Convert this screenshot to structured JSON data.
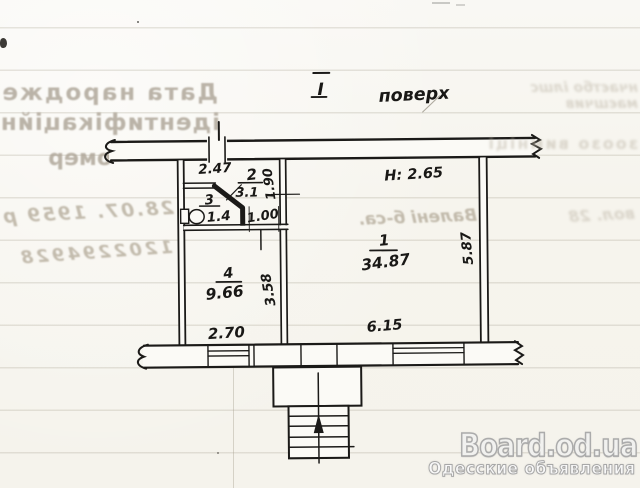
{
  "plan": {
    "title_numeral": "I",
    "title_word": "поверх",
    "height_note": "H: 2.65",
    "rooms": [
      {
        "number": "1",
        "area": "34.87"
      },
      {
        "number": "2",
        "area": "3.1"
      },
      {
        "number": "3",
        "area": "1.4"
      },
      {
        "number": "4",
        "area": "9.66"
      }
    ],
    "dims": {
      "top_width": "2.47",
      "hall_depth": "1.90",
      "hall_width": "1.00",
      "room4_depth": "3.58",
      "room4_width": "2.70",
      "room1_width": "6.15",
      "room1_depth": "5.87"
    }
  },
  "bleedthrough": {
    "form_labels": [
      "Дата народжен",
      "ідентифікаційн",
      "омер"
    ],
    "hand_date": "28.07. 1959 р",
    "id_digits": "1202294928",
    "hand_name": "Валені б-са.",
    "hand_far": "вол. 28",
    "right_rows": [
      "нчаєтбо ілшс",
      "маєшчив"
    ],
    "mid_row": "зоозо вимніці"
  },
  "watermark": {
    "brand": "Board.od.ua",
    "tagline": "Одесские объявления"
  }
}
